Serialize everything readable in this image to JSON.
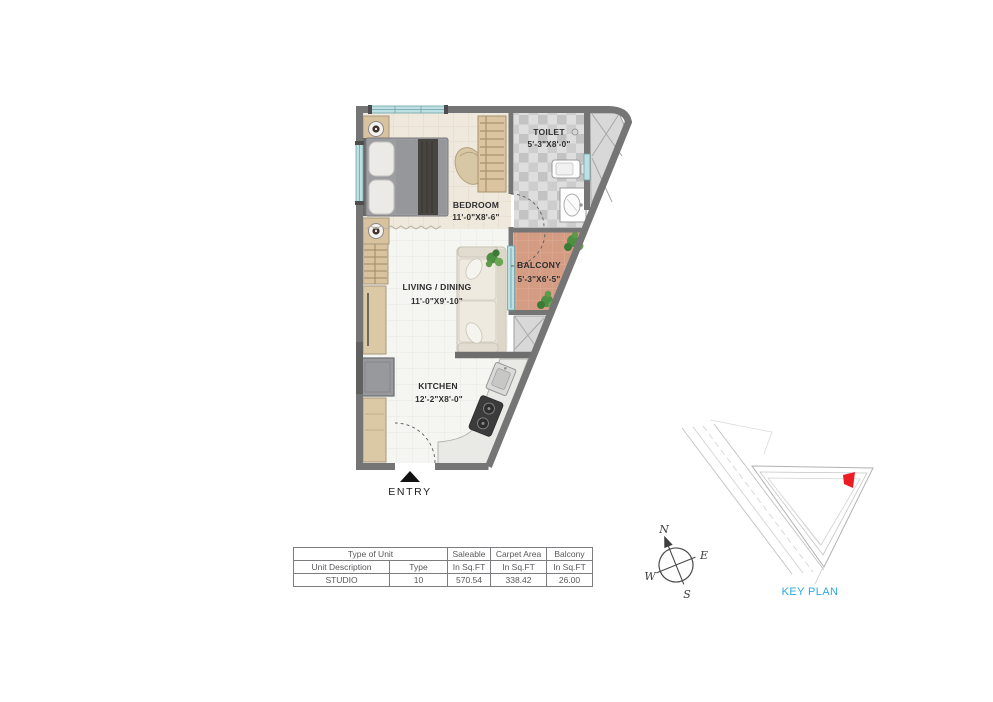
{
  "floorplan": {
    "rooms": [
      {
        "id": "bedroom",
        "name": "BEDROOM",
        "dims": "11'-0\"X8'-6\""
      },
      {
        "id": "toilet",
        "name": "TOILET",
        "dims": "5'-3\"X8'-0\""
      },
      {
        "id": "balcony",
        "name": "BALCONY",
        "dims": "5'-3\"X6'-5\""
      },
      {
        "id": "living",
        "name": "LIVING / DINING",
        "dims": "11'-0\"X9'-10\""
      },
      {
        "id": "kitchen",
        "name": "KITCHEN",
        "dims": "12'-2\"X8'-0\""
      }
    ],
    "entry_label": "ENTRY"
  },
  "compass": {
    "n": "N",
    "e": "E",
    "w": "W",
    "s": "S"
  },
  "key_plan": {
    "label": "KEY PLAN",
    "label_color": "#29abe2",
    "highlight_color": "#ed1c24"
  },
  "unit_table": {
    "row1": [
      "Type of Unit",
      "Saleable",
      "Carpet Area",
      "Balcony"
    ],
    "row2": [
      "Unit Description",
      "Type",
      "In Sq.FT",
      "In Sq.FT",
      "In Sq.FT"
    ],
    "rows": [
      [
        "STUDIO",
        "10",
        "570.54",
        "338.42",
        "26.00"
      ]
    ]
  },
  "colors": {
    "wall": "#757575",
    "balcony_floor": "#d59c84",
    "window": "#bfe0e2"
  }
}
